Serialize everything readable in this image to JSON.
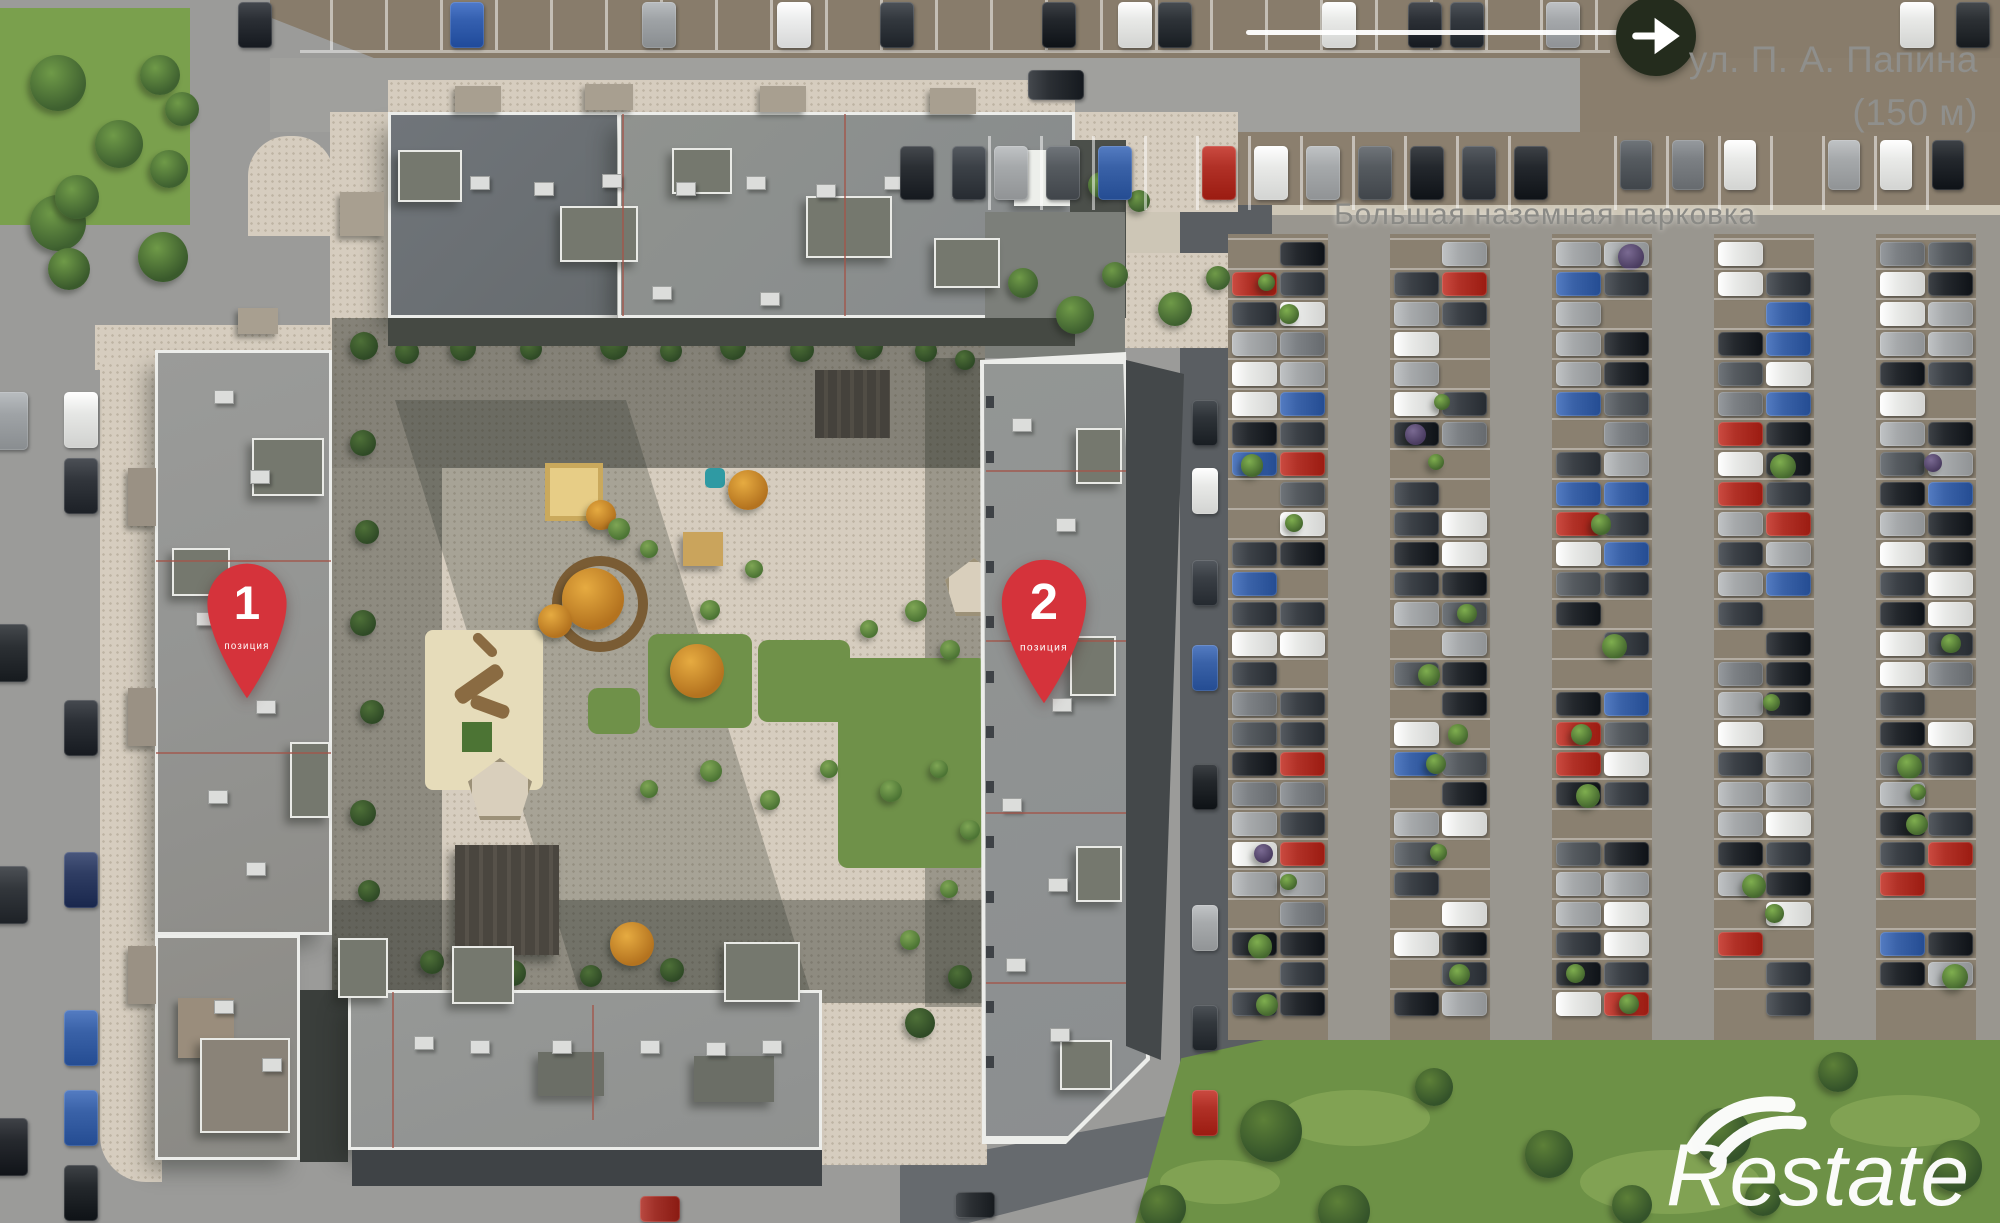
{
  "street_sign": {
    "name": "ул. П. А. Папина",
    "distance": "(150 м)"
  },
  "parking_label": "Большая наземная парковка",
  "pins": [
    {
      "number": "1",
      "label": "позиция"
    },
    {
      "number": "2",
      "label": "позиция"
    }
  ],
  "watermark": {
    "brand": "Restate"
  },
  "icons": {
    "direction": "arrow-right-icon",
    "location": "map-pin-icon",
    "brand_mark": "restate-logo-icon"
  },
  "colors": {
    "pin_red": "#d5333b",
    "label_gray": "#8d8d8a",
    "arrow_badge_bg": "#242c1d",
    "arrow_glyph": "#ffffff",
    "watermark": "#ffffff"
  }
}
